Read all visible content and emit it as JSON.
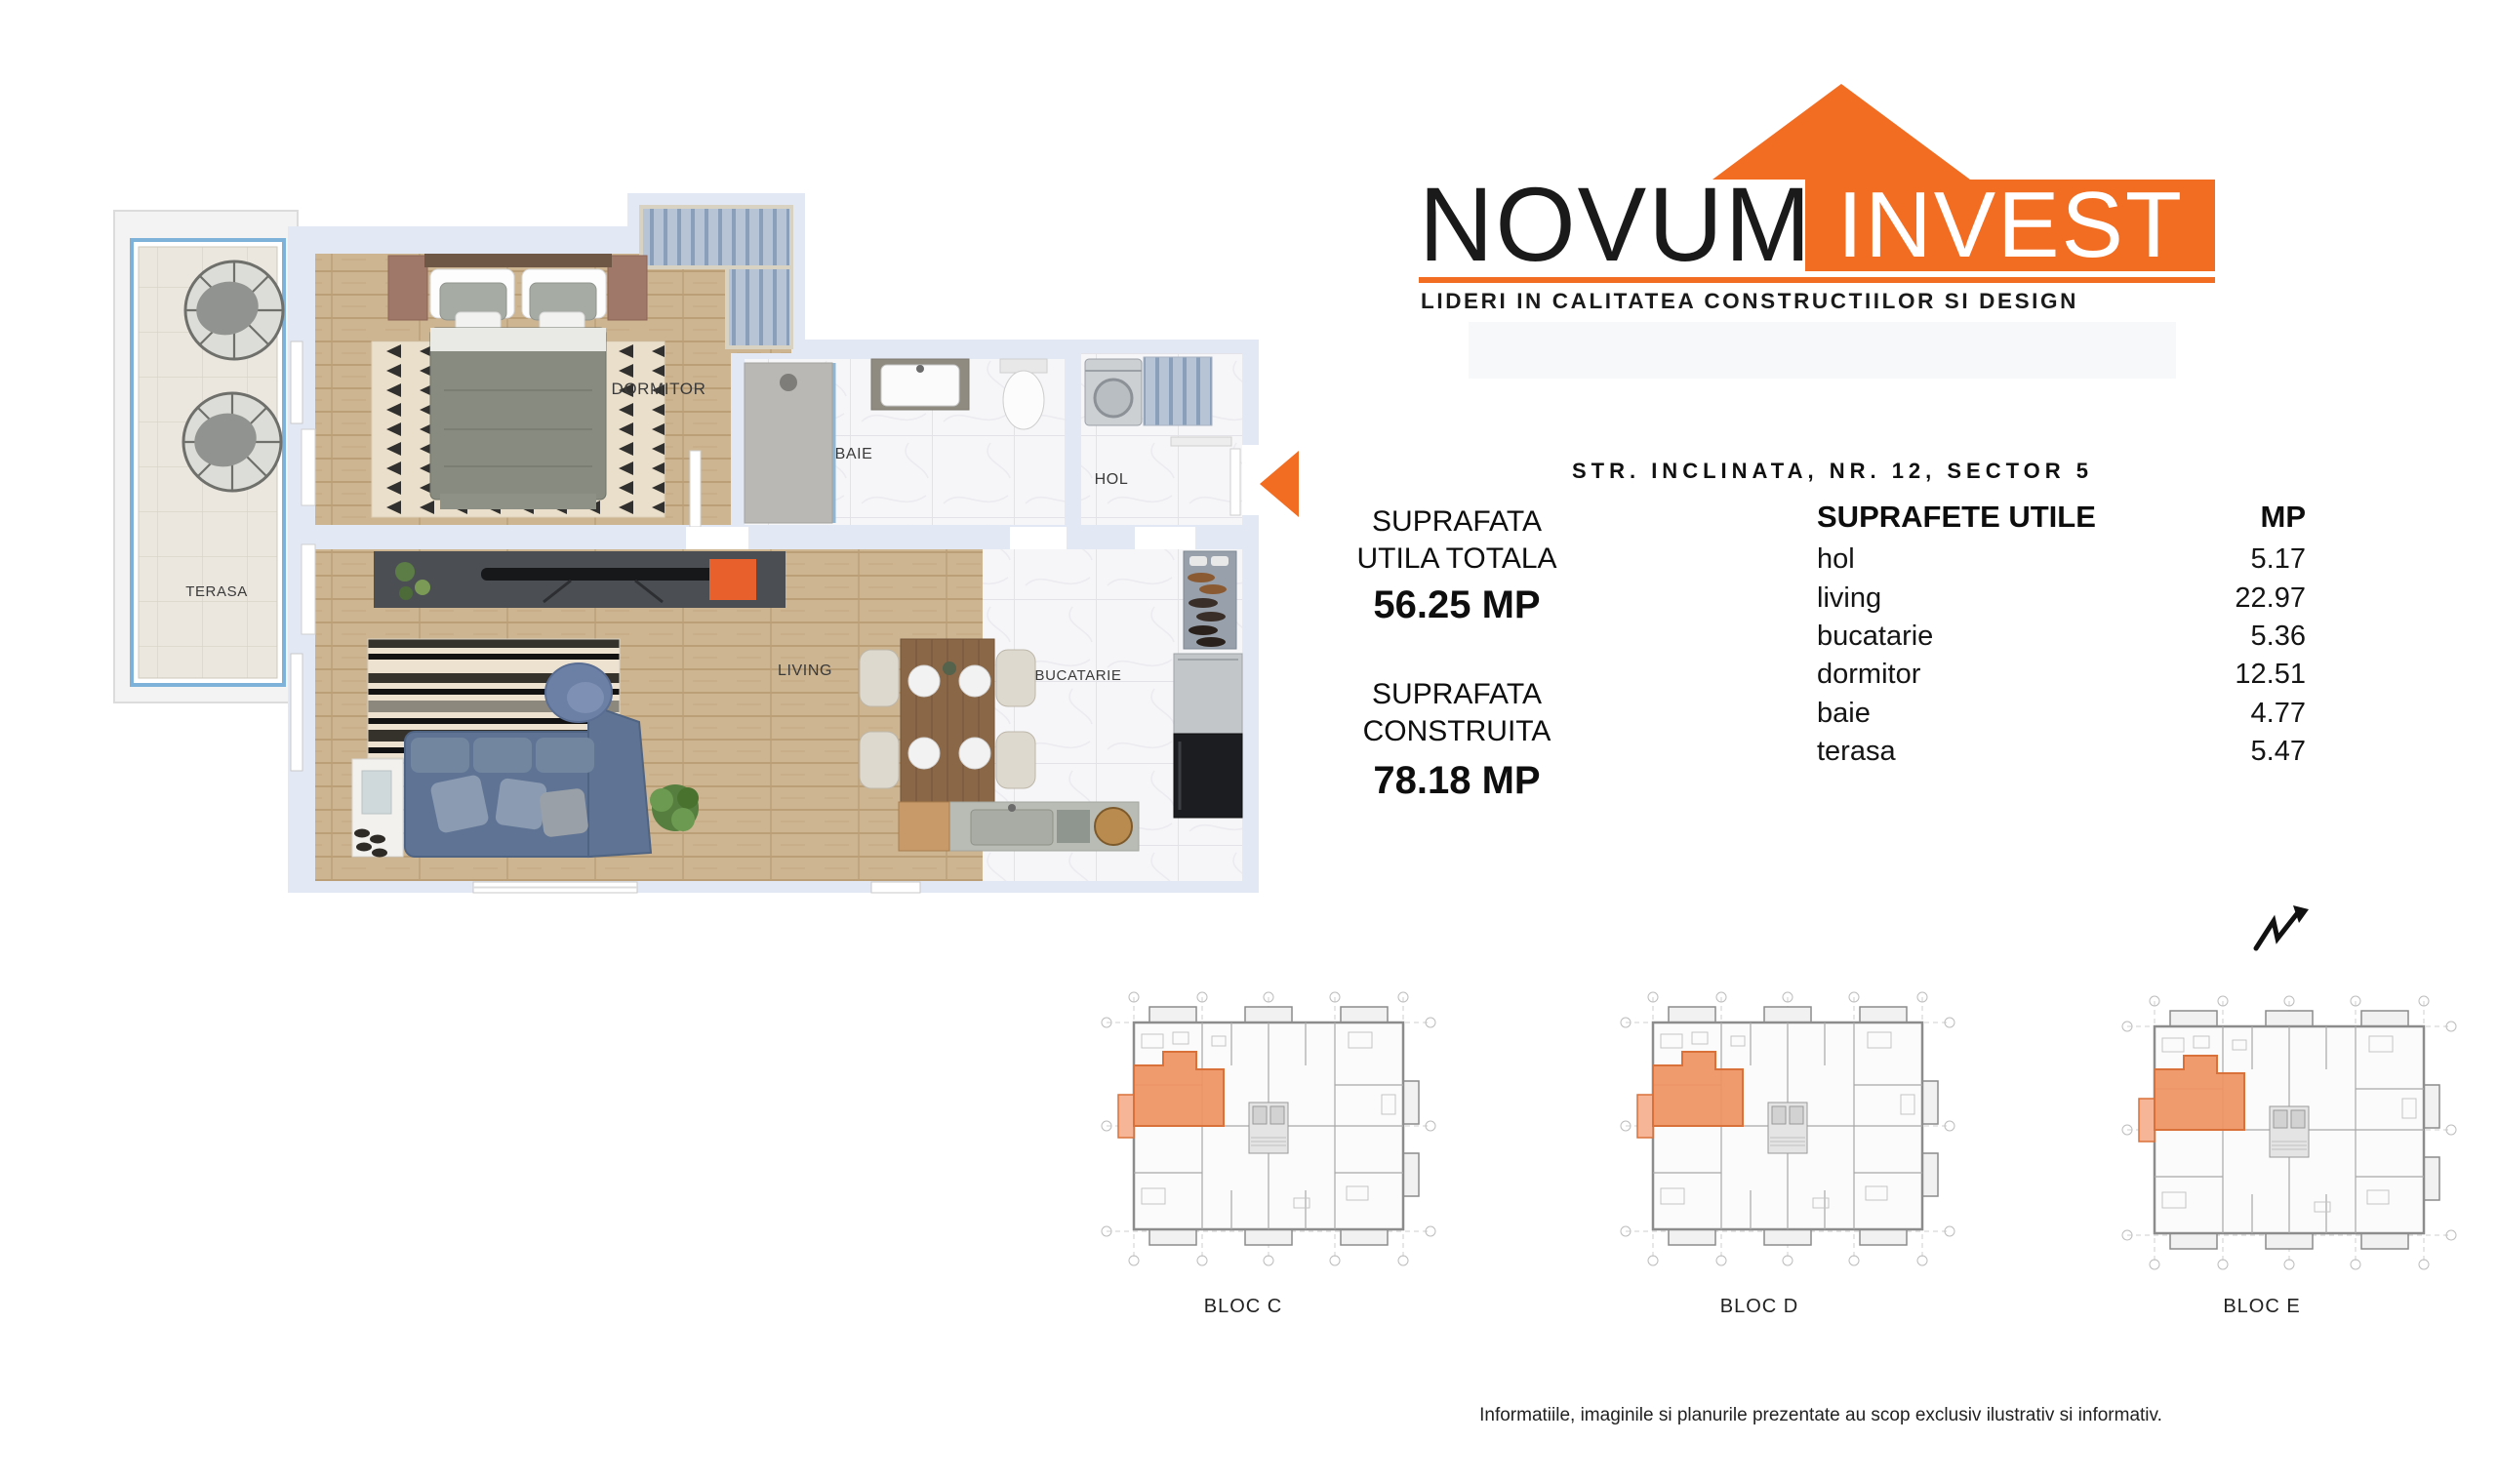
{
  "logo": {
    "brand_primary": "NOVUM",
    "brand_secondary": "INVEST",
    "tagline": "LIDERI IN CALITATEA CONSTRUCTIILOR SI DESIGN",
    "accent_color": "#F26C21"
  },
  "address": "STR. INCLINATA, NR. 12, SECTOR 5",
  "stats": {
    "useful": {
      "label_line1": "SUPRAFATA",
      "label_line2": "UTILA TOTALA",
      "value": "56.25 MP"
    },
    "built": {
      "label_line1": "SUPRAFATA",
      "label_line2": "CONSTRUITA",
      "value": "78.18 MP"
    }
  },
  "areas_table": {
    "title": "SUPRAFETE UTILE",
    "unit_header": "MP",
    "rows": [
      {
        "room": "hol",
        "mp": "5.17"
      },
      {
        "room": "living",
        "mp": "22.97"
      },
      {
        "room": "bucatarie",
        "mp": "5.36"
      },
      {
        "room": "dormitor",
        "mp": "12.51"
      },
      {
        "room": "baie",
        "mp": "4.77"
      },
      {
        "room": "terasa",
        "mp": "5.47"
      }
    ]
  },
  "floorplan": {
    "labels": {
      "terasa": "TERASA",
      "dormitor": "DORMITOR",
      "baie": "BAIE",
      "hol": "HOL",
      "living": "LIVING",
      "bucatarie": "BUCATARIE"
    },
    "entrance_arrow_color": "#F26C21",
    "highlight_color": "#EF9262"
  },
  "blocks": [
    {
      "label": "BLOC C"
    },
    {
      "label": "BLOC D"
    },
    {
      "label": "BLOC E"
    }
  ],
  "disclaimer": "Informatiile, imaginile si planurile prezentate au scop exclusiv ilustrativ si informativ."
}
